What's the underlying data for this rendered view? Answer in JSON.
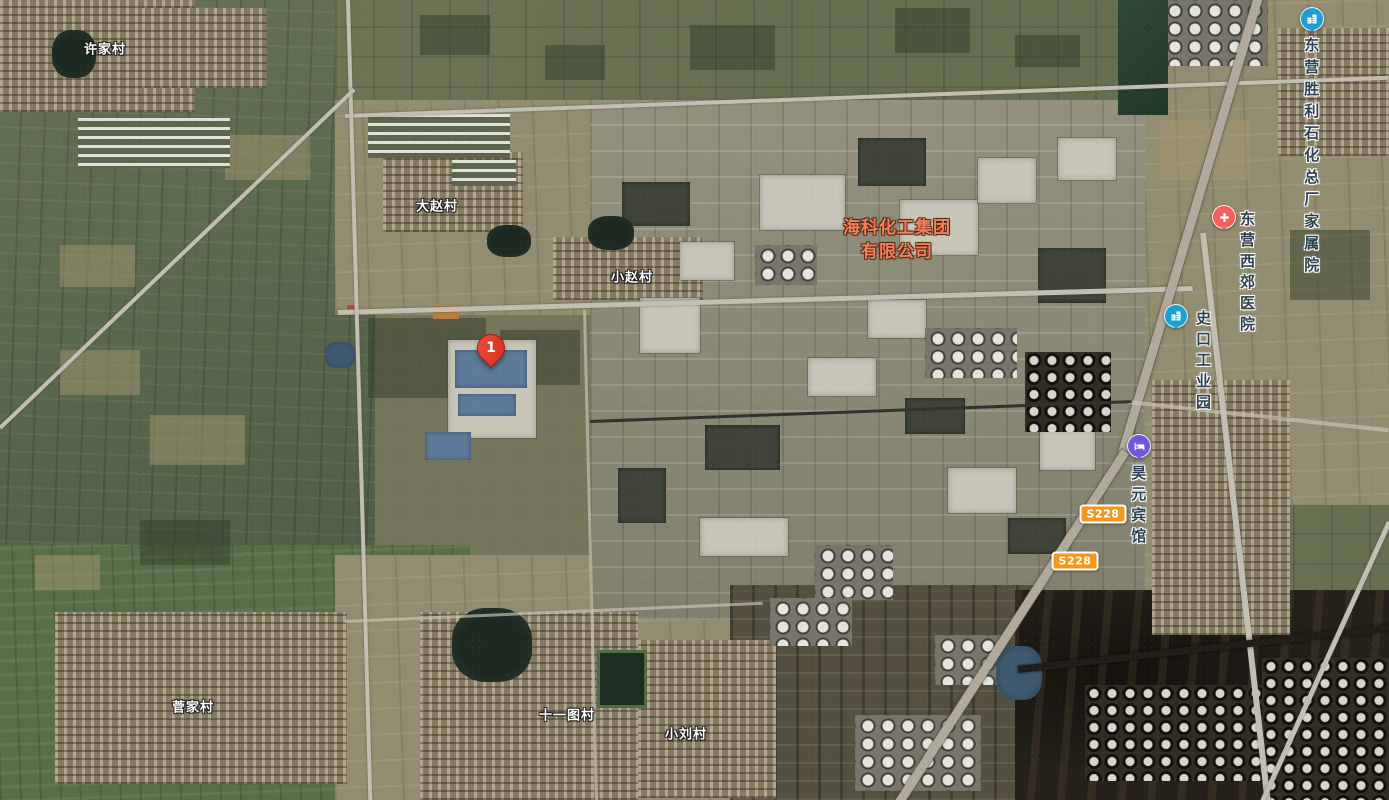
{
  "map": {
    "view": "satellite",
    "marker": {
      "label": "1",
      "color": "#e23d2c"
    },
    "company": {
      "line1": "海科化工集团",
      "line2": "有限公司",
      "color": "#f3805a"
    },
    "pois": {
      "shengli": {
        "line1": "东营胜利石化",
        "line2": "总厂家属院",
        "icon": "residential-building-icon",
        "icon_color": "#1d9fd2"
      },
      "hospital": {
        "name": "东营西郊医院",
        "icon": "hospital-cross-icon",
        "icon_color": "#f0605e"
      },
      "industrial_park": {
        "name": "史口工业园",
        "icon": "industrial-park-building-icon",
        "icon_color": "#1d9fd2"
      },
      "hotel": {
        "name": "昊元宾馆",
        "icon": "hotel-bed-icon",
        "icon_color": "#7258d8"
      }
    },
    "villages": {
      "xujia": "许家村",
      "dazhao": "大赵村",
      "xiaozhao": "小赵村",
      "jianjia": "菅家村",
      "shiyitu": "十一图村",
      "xiaoliu": "小刘村"
    },
    "road_badges": [
      "S228",
      "S228"
    ],
    "badge_color": "#f2991d"
  }
}
